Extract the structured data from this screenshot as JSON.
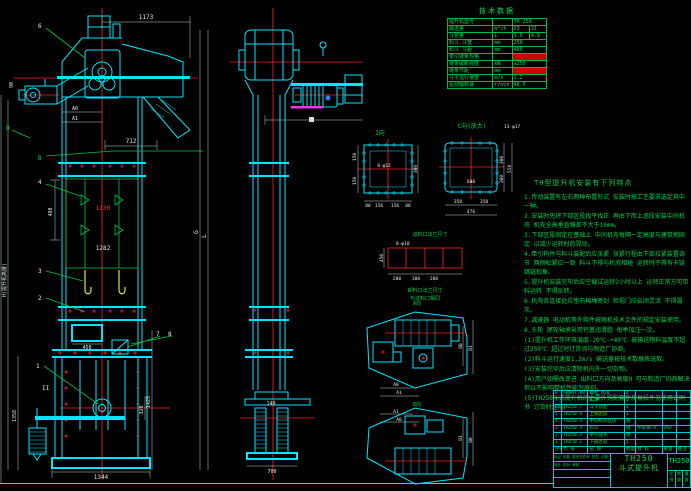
{
  "front_view": {
    "dim_1173": "1173",
    "dim_712": "712",
    "dim_a0": "A0",
    "dim_a1": "A1",
    "dim_90": "90",
    "dim_480": "480",
    "dim_1130": "1130",
    "dim_1282": "1282",
    "dim_450": "450",
    "dim_320": "320",
    "dim_1425": "1425",
    "dim_1344": "1344",
    "dim_1358": "1358",
    "label_h": "H(提升机高度)",
    "label_g": "G",
    "label_l": "L",
    "label_b": "B",
    "label_d": "D",
    "section": "II",
    "balloon_1": "1",
    "balloon_2": "2",
    "balloon_3": "3",
    "balloon_4": "4",
    "balloon_6": "6",
    "balloon_7": "7",
    "balloon_8": "8"
  },
  "side_view": {
    "dim_140": "140",
    "dim_700": "700"
  },
  "detail_i": {
    "title": "I向",
    "hole": "8-φ12",
    "dim_l1": "150",
    "dim_l2": "150",
    "dim_r": "300",
    "b0": "80",
    "b1": "156",
    "b2": "156",
    "b3": "80"
  },
  "detail_c": {
    "title": "C向(放大)",
    "hole": "13-φ17",
    "center": "600",
    "b0": "350",
    "b1": "350",
    "total": "476",
    "r0": "300",
    "r1": "300",
    "r_total": "558"
  },
  "inlet": {
    "title": "进料口法兰尺寸",
    "hole": "8-φ18",
    "dim_left": "450",
    "b0": "200",
    "b1": "300",
    "b2": "200",
    "note1": "卸料口法兰尺寸",
    "note2": "与进料口相同"
  },
  "plans": {
    "title_a": "A向",
    "title_b": "B向",
    "a0": "A0",
    "a1": "A1",
    "b0": "B0",
    "b1": "B1",
    "a0b": "A0",
    "a1b": "A1",
    "b0b": "B0",
    "b1b": "B1"
  },
  "tech_table": {
    "title": "技术数据",
    "rows": [
      [
        "提升机型号",
        "",
        "TH 250",
        ""
      ],
      [
        "输送量",
        "m³/h",
        "23",
        "31"
      ],
      [
        "斗容量",
        "L",
        "3.0",
        "4.8"
      ],
      [
        "料斗 斗宽",
        "mm",
        "250",
        ""
      ],
      [
        "料斗 斗距",
        "mm",
        "480",
        ""
      ],
      [
        "牵引链条规格",
        "",
        "",
        ""
      ],
      [
        "链条破断强度",
        "kN",
        "≥250",
        ""
      ],
      [
        "链条节距",
        "mm",
        "",
        ""
      ],
      [
        "斗子运行速度",
        "m/s",
        "1.2",
        ""
      ],
      [
        "驱动轴转速",
        "r/min",
        "48.5",
        ""
      ]
    ]
  },
  "notes": {
    "title": "TH型提升机安装有下列特点",
    "lines": [
      "1.传动装置有左右两种布置形式 安装时按工艺要求选定其中一种。",
      "2.安装时先将下部区段找平找正 再由下而上逐段安装中间机壳 机壳全高垂直偏差不大于10mm。",
      "3.下部区段固定在基础上 中间机壳每隔一定高度与建筑物固定 以减少运转时的晃动。",
      "4.牵引构件与料斗装配后应张紧 张紧行程由下部拉紧装置调节 两侧松紧应一致 料斗不得与机壳相碰 运转时不得有卡链 跳链现象。",
      "5.提升机安装完毕后应空载试运转2小时以上 运转正常方可带料运转 不得反转。",
      "6.机壳各连接处应垫石棉绳密封 检视门应启闭灵活 不得漏灰。",
      "7.减速器 电动机等外购件按随机技术文件的规定安装使用。",
      "8.头轮 尾轮轴承采用钙基润滑脂 每季加注一次。",
      "(1)提升机工作环境温度-20℃~+40℃ 被输送物料温度不超过250℃ 超过时订货须与制造厂协商。",
      "(2)料斗运行速度1.2m/s 输送量按技术数据表选取。",
      "(3)安装完毕后应清除机内外一切杂物。",
      "(4)用户如需改变进 出料口方向及高度H 可与制造厂协商解决 但以不影响整机性能为原则。",
      "(5)TH250斗式提升机的主要外购配套件及易损件见使用说明书 订货时注明。"
    ]
  },
  "bom": {
    "rows": [
      [
        "8",
        "GB907-88",
        "螺栓 M20",
        "4",
        "",
        "",
        ""
      ],
      [
        "7",
        "",
        "机架",
        "1",
        "",
        "",
        ""
      ],
      [
        "6",
        "TH250.7",
        "斗子装配",
        "1",
        "",
        "",
        ""
      ],
      [
        "5",
        "TH250.6",
        "上部区段",
        "1",
        "",
        "",
        ""
      ],
      [
        "4",
        "TH250.4",
        "中间机壳区段",
        "组",
        "",
        "",
        ""
      ],
      [
        "3",
        "TH250.3",
        "料斗",
        "组",
        "中碳钢-A",
        "203",
        ""
      ],
      [
        "2",
        "TH250.2",
        "牵引链条",
        "组",
        "",
        "",
        ""
      ],
      [
        "1",
        "TH250.1",
        "下部区段",
        "1",
        "",
        "",
        ""
      ]
    ],
    "header": [
      "序号",
      "代 号",
      "名 称",
      "数量",
      "材 料",
      "重量",
      "备注"
    ]
  },
  "title_block": {
    "model": "TH250",
    "product": "斗式提升机",
    "drawing_no": "TH250",
    "rev_strip": "标记 处数 更改文件号 签名 日期",
    "sig_strip": "设计  校对  审核",
    "cell_scale": "比例",
    "cell_qty": "数量",
    "cell_weight": "重量"
  }
}
